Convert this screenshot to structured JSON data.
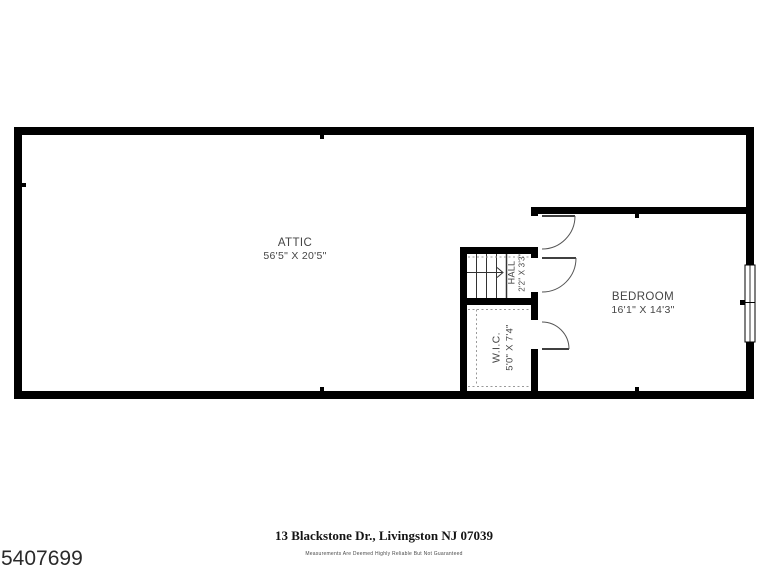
{
  "colors": {
    "wall": "#000000",
    "label": "#454545",
    "door_arc": "#555555",
    "dashed": "#999999",
    "background": "#ffffff"
  },
  "floorplan": {
    "level": "attic-level",
    "rooms": {
      "attic": {
        "name": "ATTIC",
        "dims": "56'5\" X 20'5\""
      },
      "bedroom": {
        "name": "BEDROOM",
        "dims": "16'1\" X 14'3\""
      },
      "hall": {
        "name": "HALL",
        "dims": "2'2\" X 3'3\""
      },
      "wic": {
        "name": "W.I.C.",
        "dims": "5'0\" X 7'4\""
      }
    }
  },
  "footer": {
    "address": "13 Blackstone Dr., Livingston NJ 07039",
    "disclaimer": "Measurements Are Deemed Highly Reliable But Not Guaranteed"
  },
  "listing_number": "5407699"
}
